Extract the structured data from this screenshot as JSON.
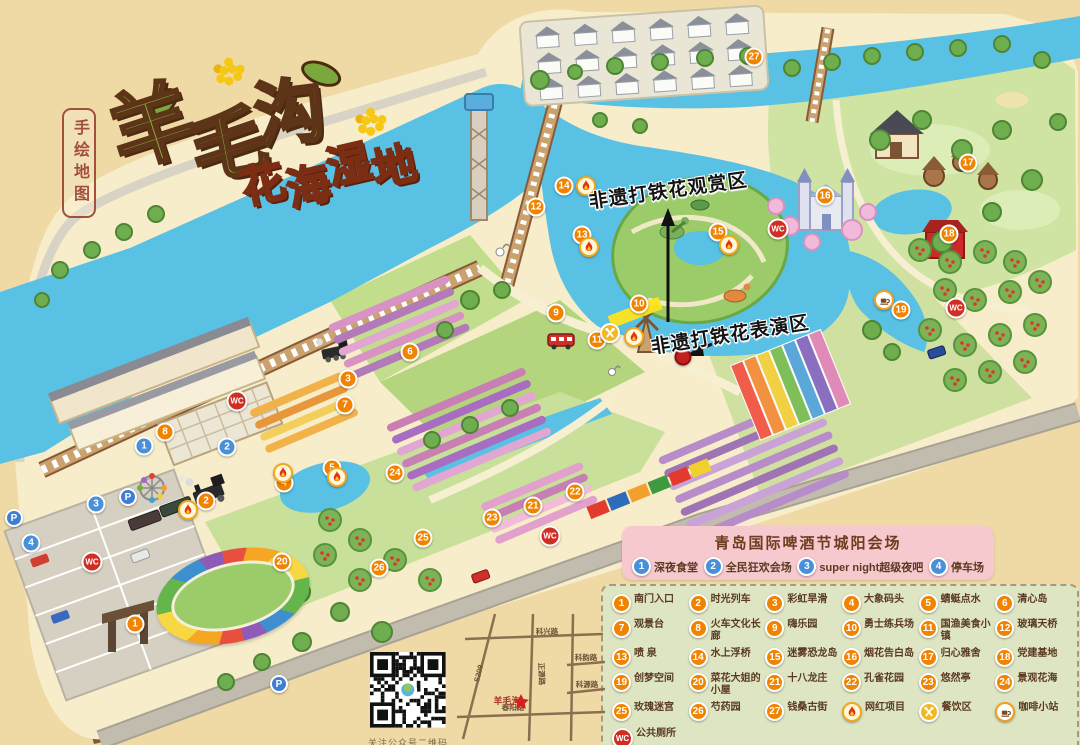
{
  "title": {
    "main": "羊毛沟",
    "sub": "花海湿地",
    "side_label": "手绘地图"
  },
  "annotations": {
    "viewing_area": "非遗打铁花观赏区",
    "performance_area": "非遗打铁花表演区"
  },
  "beer_festival": {
    "title": "青岛国际啤酒节城阳会场",
    "items": [
      {
        "icon": "1",
        "label": "深夜食堂"
      },
      {
        "icon": "2",
        "label": "全民狂欢会场"
      },
      {
        "icon": "3",
        "label": "super night超级夜吧"
      },
      {
        "icon": "4",
        "label": "停车场"
      }
    ]
  },
  "legend": {
    "items": [
      {
        "icon": "1",
        "label": "南门入口"
      },
      {
        "icon": "2",
        "label": "时光列车"
      },
      {
        "icon": "3",
        "label": "彩虹旱滑"
      },
      {
        "icon": "4",
        "label": "大象码头"
      },
      {
        "icon": "5",
        "label": "蜻蜓点水"
      },
      {
        "icon": "6",
        "label": "清心岛"
      },
      {
        "icon": "7",
        "label": "观景台"
      },
      {
        "icon": "8",
        "label": "火车文化长廊"
      },
      {
        "icon": "9",
        "label": "嗨乐园"
      },
      {
        "icon": "10",
        "label": "勇士练兵场"
      },
      {
        "icon": "11",
        "label": "国渔美食小镇"
      },
      {
        "icon": "12",
        "label": "玻璃天桥"
      },
      {
        "icon": "13",
        "label": "喷 泉"
      },
      {
        "icon": "14",
        "label": "水上浮桥"
      },
      {
        "icon": "15",
        "label": "迷雾恐龙岛"
      },
      {
        "icon": "16",
        "label": "烟花告白岛"
      },
      {
        "icon": "17",
        "label": "归心雅舍"
      },
      {
        "icon": "18",
        "label": "党建基地"
      },
      {
        "icon": "19",
        "label": "创梦空间"
      },
      {
        "icon": "20",
        "label": "菜花大姐的小屋"
      },
      {
        "icon": "21",
        "label": "十八龙庄"
      },
      {
        "icon": "22",
        "label": "孔雀花园"
      },
      {
        "icon": "23",
        "label": "悠然亭"
      },
      {
        "icon": "24",
        "label": "景观花海"
      },
      {
        "icon": "25",
        "label": "玫瑰迷宫"
      },
      {
        "icon": "26",
        "label": "芍药园"
      },
      {
        "icon": "27",
        "label": "钱桑古街"
      },
      {
        "icon": "flame",
        "label": "网红项目"
      },
      {
        "icon": "food",
        "label": "餐饮区"
      },
      {
        "icon": "coffee",
        "label": "咖啡小站"
      },
      {
        "icon": "wc",
        "label": "公共厕所"
      }
    ]
  },
  "qr": {
    "caption": "关注公众号二维码"
  },
  "mini_map": {
    "star_label": "羊毛沟",
    "road_top": "科兴路",
    "road_diagonal": "S209",
    "road_vertical": "正源路",
    "road_right1": "科韵路",
    "road_right2": "科源路",
    "road_bottom": "春阳路"
  },
  "markers": [
    {
      "t": "num",
      "l": "1",
      "x": 135,
      "y": 624
    },
    {
      "t": "num",
      "l": "2",
      "x": 206,
      "y": 501
    },
    {
      "t": "num",
      "l": "3",
      "x": 348,
      "y": 379
    },
    {
      "t": "num",
      "l": "4",
      "x": 284,
      "y": 483
    },
    {
      "t": "num",
      "l": "5",
      "x": 332,
      "y": 468
    },
    {
      "t": "num",
      "l": "6",
      "x": 410,
      "y": 352
    },
    {
      "t": "num",
      "l": "7",
      "x": 345,
      "y": 405
    },
    {
      "t": "num",
      "l": "8",
      "x": 165,
      "y": 432
    },
    {
      "t": "num",
      "l": "9",
      "x": 556,
      "y": 313
    },
    {
      "t": "num",
      "l": "10",
      "x": 639,
      "y": 304
    },
    {
      "t": "num",
      "l": "11",
      "x": 597,
      "y": 340
    },
    {
      "t": "num",
      "l": "12",
      "x": 536,
      "y": 207
    },
    {
      "t": "num",
      "l": "13",
      "x": 582,
      "y": 235
    },
    {
      "t": "num",
      "l": "14",
      "x": 564,
      "y": 186
    },
    {
      "t": "num",
      "l": "15",
      "x": 718,
      "y": 232
    },
    {
      "t": "num",
      "l": "16",
      "x": 825,
      "y": 196
    },
    {
      "t": "num",
      "l": "17",
      "x": 968,
      "y": 163
    },
    {
      "t": "num",
      "l": "18",
      "x": 949,
      "y": 234
    },
    {
      "t": "num",
      "l": "19",
      "x": 901,
      "y": 310
    },
    {
      "t": "num",
      "l": "20",
      "x": 282,
      "y": 562
    },
    {
      "t": "num",
      "l": "21",
      "x": 533,
      "y": 506
    },
    {
      "t": "num",
      "l": "22",
      "x": 575,
      "y": 492
    },
    {
      "t": "num",
      "l": "23",
      "x": 492,
      "y": 518
    },
    {
      "t": "num",
      "l": "24",
      "x": 395,
      "y": 473
    },
    {
      "t": "num",
      "l": "25",
      "x": 423,
      "y": 538
    },
    {
      "t": "num",
      "l": "26",
      "x": 379,
      "y": 568
    },
    {
      "t": "num",
      "l": "27",
      "x": 754,
      "y": 57
    },
    {
      "t": "blue",
      "l": "1",
      "x": 144,
      "y": 446
    },
    {
      "t": "blue",
      "l": "2",
      "x": 227,
      "y": 447
    },
    {
      "t": "blue",
      "l": "3",
      "x": 96,
      "y": 504
    },
    {
      "t": "blue",
      "l": "4",
      "x": 31,
      "y": 543
    },
    {
      "t": "p",
      "l": "P",
      "x": 14,
      "y": 518
    },
    {
      "t": "p",
      "l": "P",
      "x": 128,
      "y": 497
    },
    {
      "t": "p",
      "l": "P",
      "x": 279,
      "y": 684
    },
    {
      "t": "p",
      "l": "P",
      "x": 381,
      "y": 688
    },
    {
      "t": "wc",
      "l": "WC",
      "x": 237,
      "y": 401
    },
    {
      "t": "wc",
      "l": "WC",
      "x": 778,
      "y": 229
    },
    {
      "t": "wc",
      "l": "WC",
      "x": 956,
      "y": 308
    },
    {
      "t": "wc",
      "l": "WC",
      "x": 550,
      "y": 536
    },
    {
      "t": "wc",
      "l": "WC",
      "x": 92,
      "y": 562
    },
    {
      "t": "flame",
      "l": "",
      "x": 188,
      "y": 510
    },
    {
      "t": "flame",
      "l": "",
      "x": 283,
      "y": 473
    },
    {
      "t": "flame",
      "l": "",
      "x": 337,
      "y": 477
    },
    {
      "t": "flame",
      "l": "",
      "x": 586,
      "y": 186
    },
    {
      "t": "flame",
      "l": "",
      "x": 589,
      "y": 247
    },
    {
      "t": "flame",
      "l": "",
      "x": 729,
      "y": 245
    },
    {
      "t": "flame",
      "l": "",
      "x": 634,
      "y": 337
    },
    {
      "t": "food",
      "l": "",
      "x": 610,
      "y": 333
    },
    {
      "t": "coffee",
      "l": "",
      "x": 884,
      "y": 300
    },
    {
      "t": "dot",
      "l": "",
      "x": 683,
      "y": 357
    }
  ]
}
